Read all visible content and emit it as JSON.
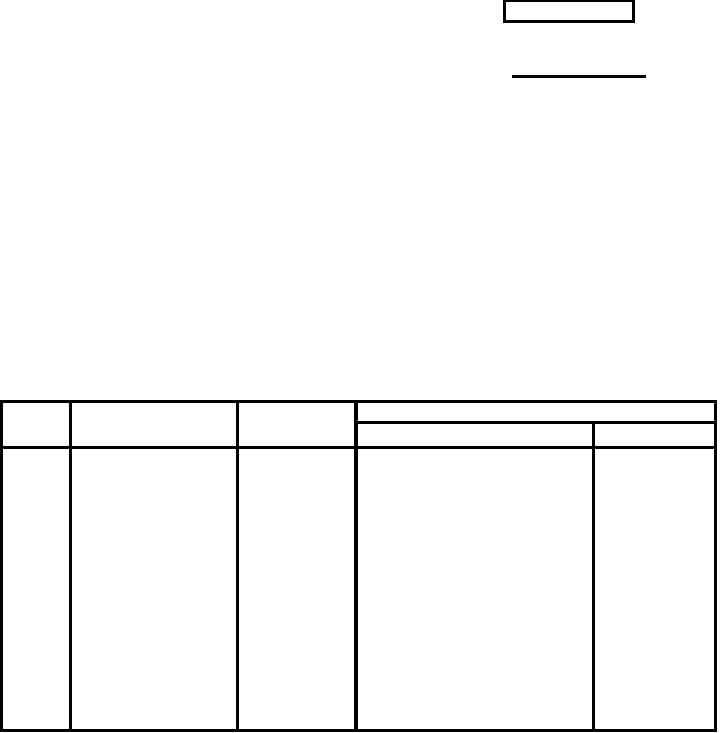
{
  "page": {
    "background_color": "#ffffff",
    "rule_color": "#000000"
  },
  "header": {
    "box_value": "",
    "underline_value": ""
  },
  "table": {
    "header_cells": [
      "",
      "",
      ""
    ],
    "group_header": "",
    "sub_headers": [
      "",
      ""
    ],
    "body_cells": [
      "",
      "",
      "",
      "",
      ""
    ]
  }
}
